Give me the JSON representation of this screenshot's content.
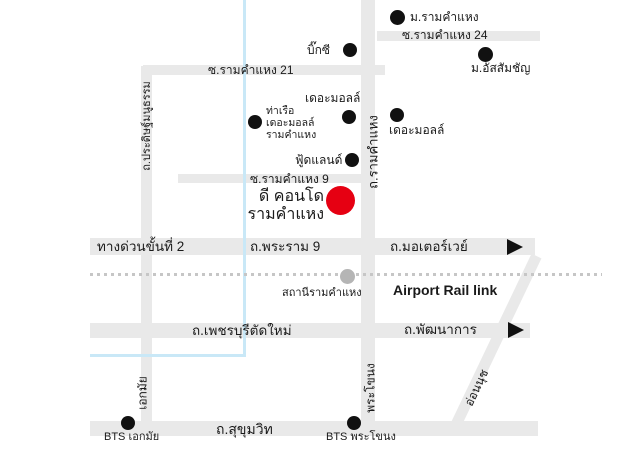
{
  "colors": {
    "road": "#e9e9e9",
    "canal": "#c9e8f7",
    "rail_dash": "#c6c6c6",
    "station_dot": "#b5b5b5",
    "landmark_dot": "#111111",
    "condo_marker": "#e60012",
    "text": "#1a1a1a"
  },
  "roads": {
    "soi_ramkhamhaeng_24": "ซ.รามคำแหง 24",
    "soi_ramkhamhaeng_21": "ซ.รามคำแหง 21",
    "soi_ramkhamhaeng_9": "ซ.รามคำแหง 9",
    "expressway_stage_2": "ทางด่วนขั้นที่ 2",
    "rama_9": "ถ.พระราม 9",
    "motorway": "ถ.มอเตอร์เวย์",
    "new_phetchaburi": "ถ.เพชรบุรีตัดใหม่",
    "phatthanakan": "ถ.พัฒนาการ",
    "sukhumvit": "ถ.สุขุมวิท",
    "pradit_manutham": "ถ.ประดิษฐ์มนูธรรม",
    "ekkamai": "เอกมัย",
    "ramkhamhaeng": "ถ.รามคำแหง",
    "phra_khanong": "พระโขนง",
    "on_nut": "อ่อนนุช"
  },
  "rail": {
    "line": "Airport Rail link",
    "station": "สถานีรามคำแหง"
  },
  "landmarks": {
    "ramkhamhaeng_university": "ม.รามคำแหง",
    "assumption_university": "ม.อัสสัมชัญ",
    "big_c": "บิ๊กซี",
    "the_mall_east": "เดอะมอลล์",
    "the_mall_west": "เดอะมอลล์",
    "pier": {
      "line1": "ท่าเรือ",
      "line2": "เดอะมอลล์",
      "line3": "รามคำแหง"
    },
    "foodland": "ฟู้ดแลนด์"
  },
  "marker": {
    "line1": "ดี คอนโด",
    "line2": "รามคำแหง"
  },
  "bts": {
    "ekkamai": "BTS เอกมัย",
    "phra_khanong": "BTS พระโขนง"
  }
}
